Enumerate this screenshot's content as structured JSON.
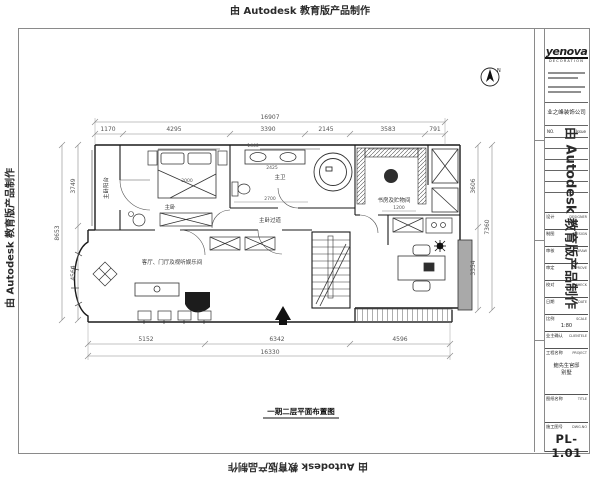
{
  "watermark": {
    "text": "由 Autodesk 教育版产品制作"
  },
  "plan": {
    "caption": "一期二层平面布置图",
    "compass": "N",
    "rooms": {
      "balcony": "主卧阳台",
      "bedroom": "主卧",
      "bath": "主卫",
      "corridor": "主卧过道",
      "study": "书房及贮物间",
      "living": "客厅、门厅及视听娱乐间"
    },
    "dims": {
      "top_total": "16907",
      "top": [
        "1170",
        "4295",
        "3390",
        "2145",
        "3583",
        "791"
      ],
      "left_total": "8653",
      "left": [
        "3749",
        "4564"
      ],
      "right_total": "7360",
      "right": [
        "3606",
        "3354"
      ],
      "bottom_total": "16330",
      "bottom": [
        "5152",
        "6342",
        "4596"
      ],
      "bed_width": "2000",
      "bath_top": "1440",
      "bath_counter": "2425",
      "bath_width": "2700",
      "desk_width": "1200"
    }
  },
  "title_block": {
    "logo": "yenova",
    "logo_sub": "DECORATION",
    "company": "业之峰装饰公司",
    "rev": {
      "no": "NO.",
      "issue": "Issue"
    },
    "fields": [
      {
        "label": "设计",
        "en": "DESIGNER",
        "value": ""
      },
      {
        "label": "制图",
        "en": "DESIGN",
        "value": ""
      },
      {
        "label": "审核",
        "en": "DRAW",
        "value": ""
      },
      {
        "label": "审定",
        "en": "APPROVE",
        "value": ""
      },
      {
        "label": "校对",
        "en": "CHECK",
        "value": ""
      },
      {
        "label": "日期",
        "en": "DATE",
        "value": ""
      },
      {
        "label": "比例",
        "en": "SCALE",
        "value": "1:80"
      },
      {
        "label": "业主确认",
        "en": "CLIENTELE",
        "value": ""
      }
    ],
    "project": {
      "label": "工程名称",
      "en": "PROJECT",
      "line1": "鲍先生官邸",
      "line2": "别墅"
    },
    "sheet_title": {
      "label": "图纸名称",
      "en": "TITLE",
      "value": ""
    },
    "dwg": {
      "label": "施工图号",
      "en": "DWG.NO",
      "number": "PL-1.01"
    }
  }
}
